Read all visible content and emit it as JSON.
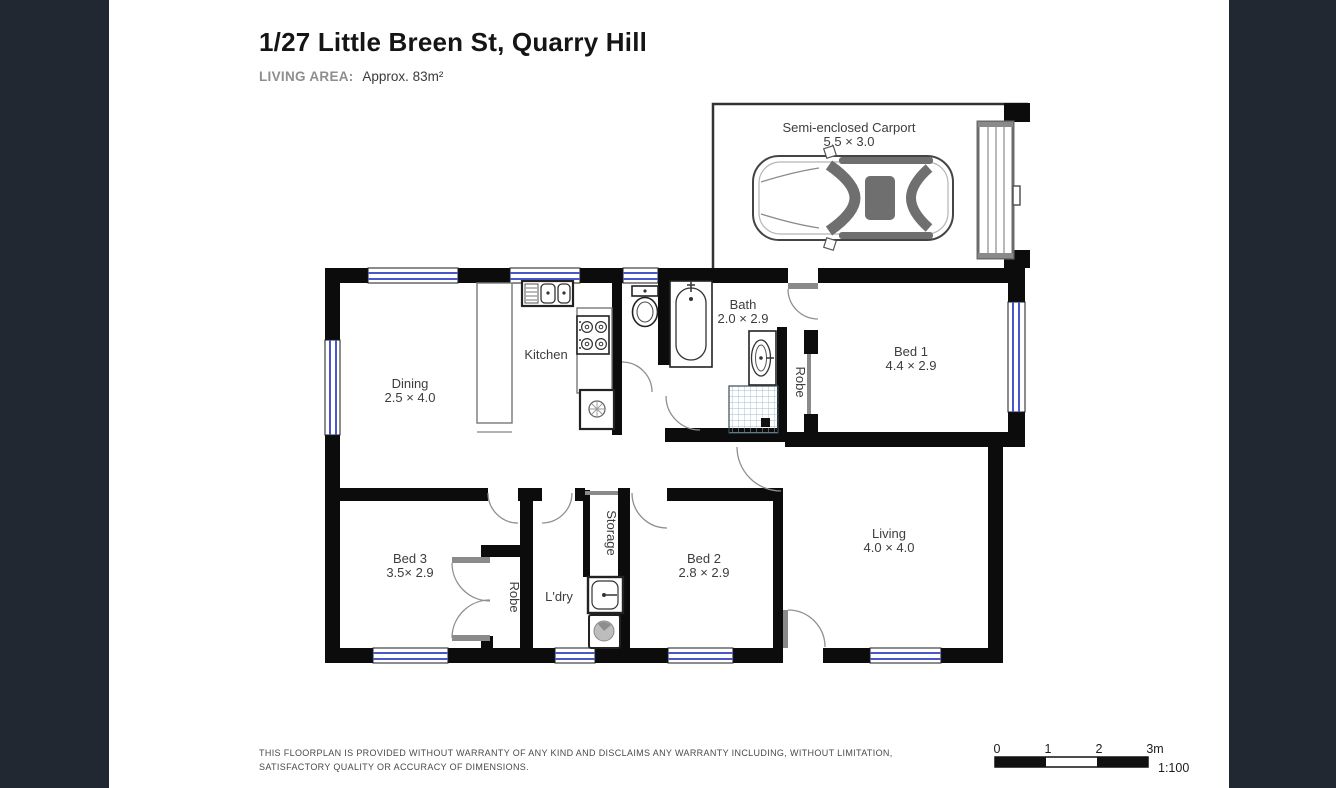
{
  "header": {
    "title": "1/27 Little Breen St, Quarry Hill",
    "living_area_label": "LIVING AREA:",
    "living_area_value": "Approx. 83m²"
  },
  "rooms": {
    "carport": {
      "name": "Semi-enclosed Carport",
      "dims": "5.5 × 3.0"
    },
    "dining": {
      "name": "Dining",
      "dims": "2.5 × 4.0"
    },
    "kitchen": {
      "name": "Kitchen"
    },
    "bath": {
      "name": "Bath",
      "dims": "2.0 × 2.9"
    },
    "bed1": {
      "name": "Bed 1",
      "dims": "4.4 × 2.9"
    },
    "robe_bed1": {
      "name": "Robe"
    },
    "bed3": {
      "name": "Bed 3",
      "dims": "3.5× 2.9"
    },
    "robe_bed3": {
      "name": "Robe"
    },
    "laundry": {
      "name": "L'dry"
    },
    "storage": {
      "name": "Storage"
    },
    "bed2": {
      "name": "Bed 2",
      "dims": "2.8 × 2.9"
    },
    "living": {
      "name": "Living",
      "dims": "4.0 × 4.0"
    }
  },
  "footer": {
    "disclaimer_line1": "THIS FLOORPLAN IS PROVIDED WITHOUT WARRANTY OF ANY KIND AND DISCLAIMS ANY WARRANTY INCLUDING, WITHOUT LIMITATION,",
    "disclaimer_line2": "SATISFACTORY QUALITY OR ACCURACY OF DIMENSIONS.",
    "scale_ticks": [
      "0",
      "1",
      "2",
      "3m"
    ],
    "scale_ratio": "1:100"
  },
  "colors": {
    "canvas_background": "#222831",
    "page_background": "#ffffff",
    "wall": "#0c0c0c",
    "window_glass": "#4a57c8",
    "label_text": "#3d3d3d"
  }
}
